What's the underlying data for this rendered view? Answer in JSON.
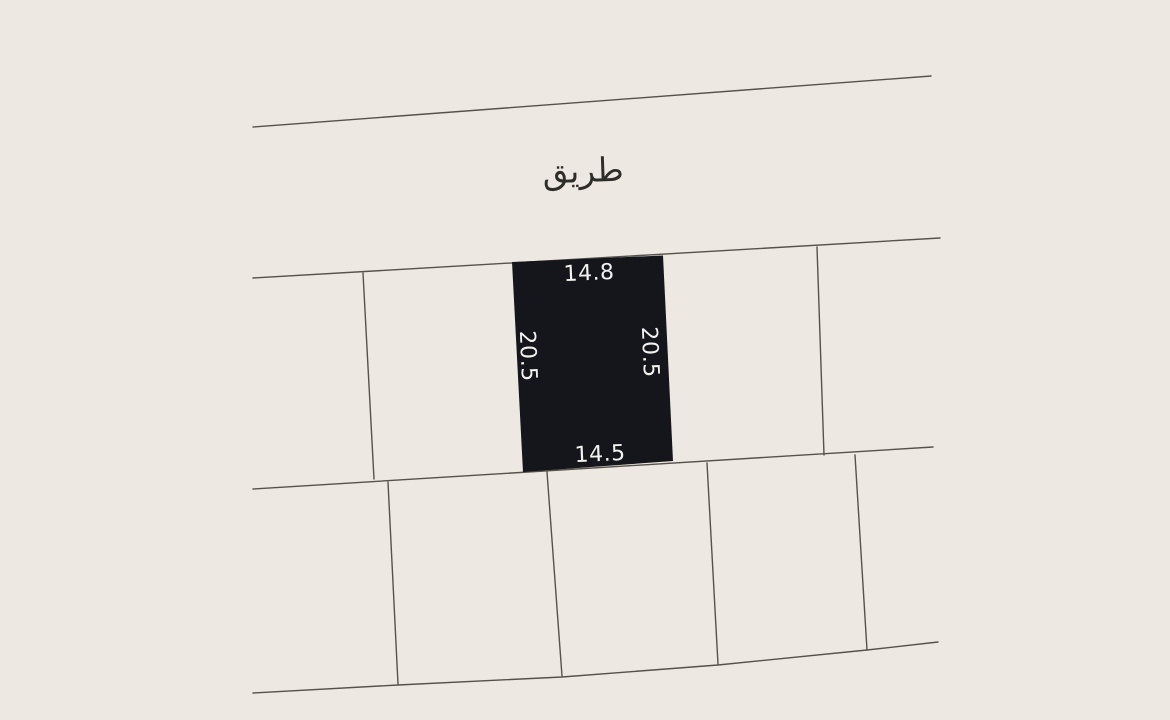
{
  "map": {
    "background_color": "#EDE9E2",
    "line_color": "#56524B",
    "road": {
      "label": "طريق",
      "label_color": "#2F2D29"
    },
    "selected_plot": {
      "fill": "#15151C",
      "label_color": "#F3F2F0",
      "dimensions": {
        "top": "14.8",
        "bottom": "14.5",
        "left": "20.5",
        "right": "20.5"
      }
    }
  }
}
